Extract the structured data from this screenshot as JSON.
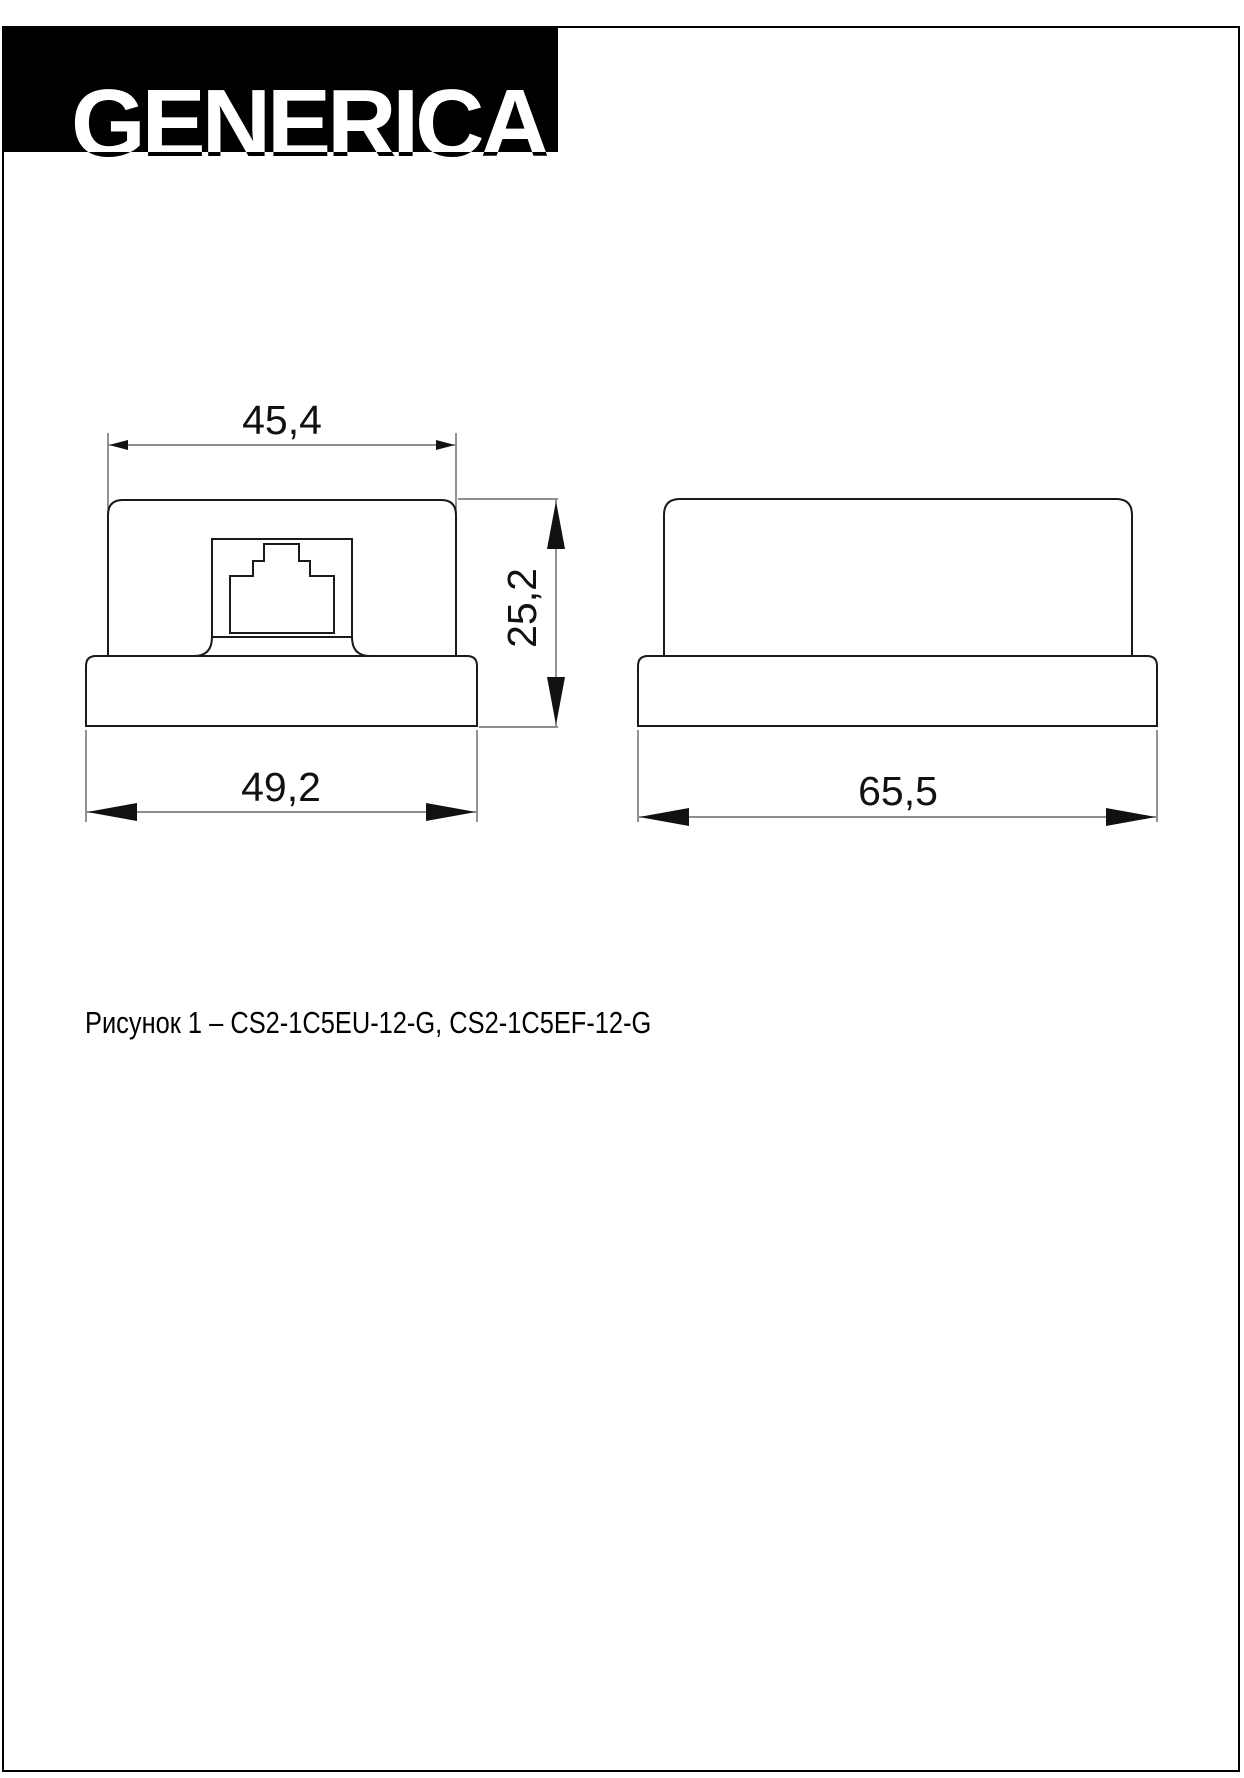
{
  "page": {
    "background": "#ffffff",
    "border_color": "#000000"
  },
  "logo": {
    "text": "GENERICA",
    "background": "#000000",
    "text_color": "#ffffff"
  },
  "drawing": {
    "dimensions": {
      "front_top_width": "45,4",
      "front_height": "25,2",
      "front_base_width": "49,2",
      "side_base_width": "65,5"
    }
  },
  "caption": {
    "text": "Рисунок 1 – CS2-1C5EU-12-G, CS2-1C5EF-12-G"
  }
}
